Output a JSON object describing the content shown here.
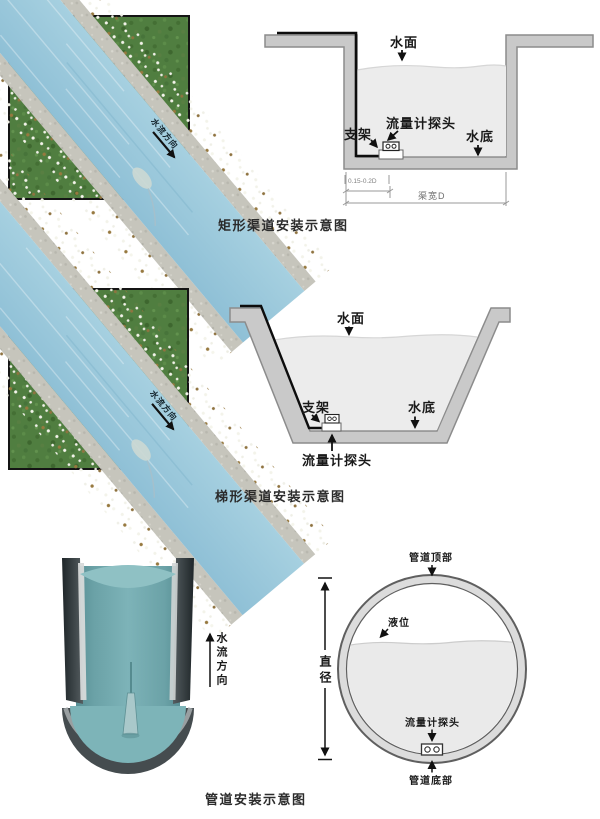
{
  "colors": {
    "diagram_wall_fill": "#c9c9c9",
    "diagram_wall_stroke": "#8c8c8c",
    "diagram_water_fill": "#ececec",
    "cable_black": "#0d0d0d",
    "label_text": "#1a1a1a",
    "dim_gray": "#808080",
    "photo_grass_green": "#507e40",
    "photo_water_blue": "#9ccadd",
    "photo_concrete_gray": "#c6c5bc",
    "pipe_water_teal": "#6fa7ac"
  },
  "sections": {
    "rect": {
      "caption": "矩形渠道安装示意图",
      "photo": {
        "flow_label": "水流方向"
      },
      "labels": {
        "water_surface": "水面",
        "probe": "流量计探头",
        "bracket": "支架",
        "water_bottom": "水底"
      },
      "dims": {
        "offset": "0.15-0.2D",
        "width": "渠宽D"
      }
    },
    "trap": {
      "caption": "梯形渠道安装示意图",
      "photo": {
        "flow_label": "水流方向"
      },
      "labels": {
        "water_surface": "水面",
        "bracket": "支架",
        "water_bottom": "水底",
        "probe": "流量计探头"
      }
    },
    "pipe": {
      "caption": "管道安装示意图",
      "labels": {
        "pipe_top": "管道顶部",
        "liquid_level": "液位",
        "diameter": "直径",
        "probe": "流量计探头",
        "pipe_bottom": "管道底部",
        "flow_direction": "水流方向"
      }
    }
  }
}
